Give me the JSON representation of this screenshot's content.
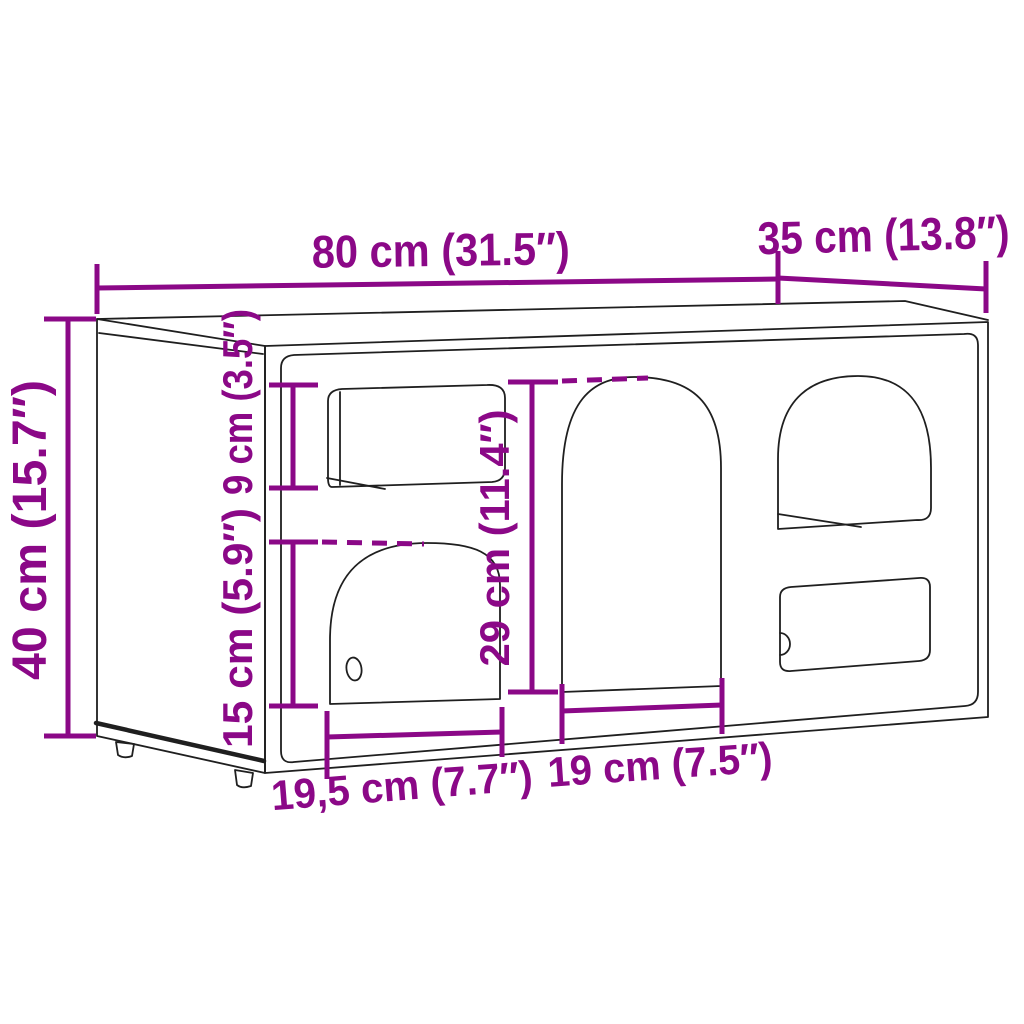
{
  "diagram": {
    "kind": "furniture-dimension-diagram",
    "accent_color": "#8B0887",
    "outline_color": "#1f1f1f",
    "background_color": "#ffffff",
    "dims": {
      "width": {
        "label": "80 cm (31.5″)"
      },
      "depth": {
        "label": "35 cm (13.8″)"
      },
      "height": {
        "label": "40 cm (15.7″)"
      },
      "top_opening_height": {
        "label": "9 cm (3.5″)"
      },
      "left_arch_height": {
        "label": "15 cm (5.9″)"
      },
      "middle_arch_height": {
        "label": "29 cm (11.4″)"
      },
      "left_arch_width": {
        "label": "19,5 cm (7.7″)"
      },
      "middle_arch_width": {
        "label": "19 cm (7.5″)"
      }
    }
  }
}
